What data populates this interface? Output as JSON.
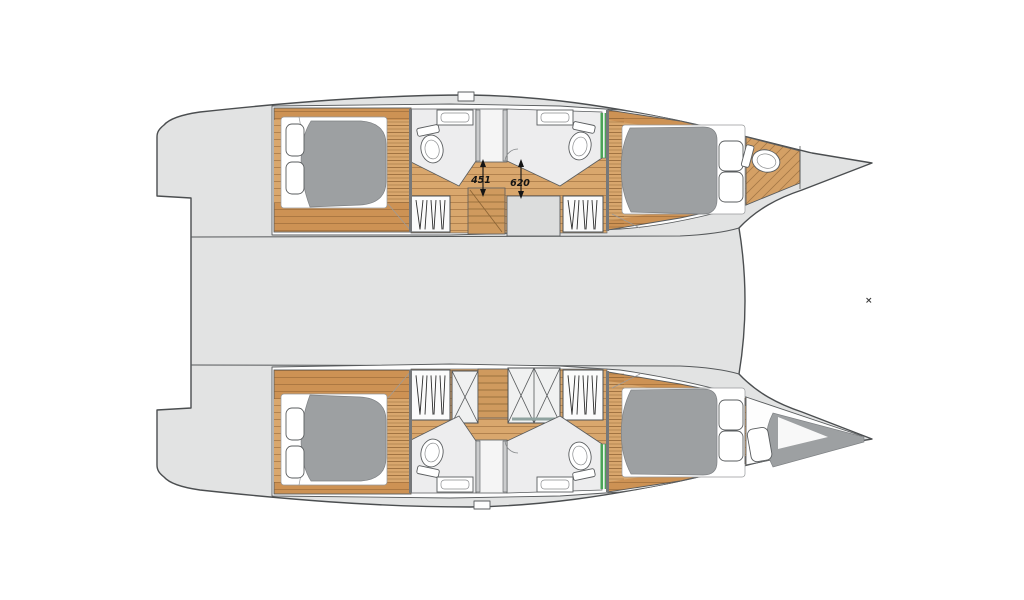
{
  "plan": {
    "description": "catamaran yacht interior floor plan, top view, bow to the right",
    "dimension_labels": [
      "451",
      "620"
    ],
    "marker_glyph": "×",
    "icons": {
      "toilet": "oval-bowl-with-tank",
      "sink": "rounded-rect-basin",
      "wardrobe-hangers": "vertical-zigzag-lines",
      "shower": "x-crossed-box",
      "bed": "gray-mattress-with-pillows",
      "staircase": "wood-steps"
    }
  },
  "colors": {
    "background": "#ffffff",
    "deck_gray": "#e2e3e3",
    "outline": "#4b4e50",
    "wood_light": "#d9a76d",
    "wood_dark": "#cd9254",
    "plank_line": "#8b5e2f",
    "mattress_gray": "#9da0a2",
    "bathroom_floor": "#ededee",
    "accent_green": "#4aa457",
    "cabinet_gray": "#dcdddd",
    "dimension_text": "#141414"
  }
}
